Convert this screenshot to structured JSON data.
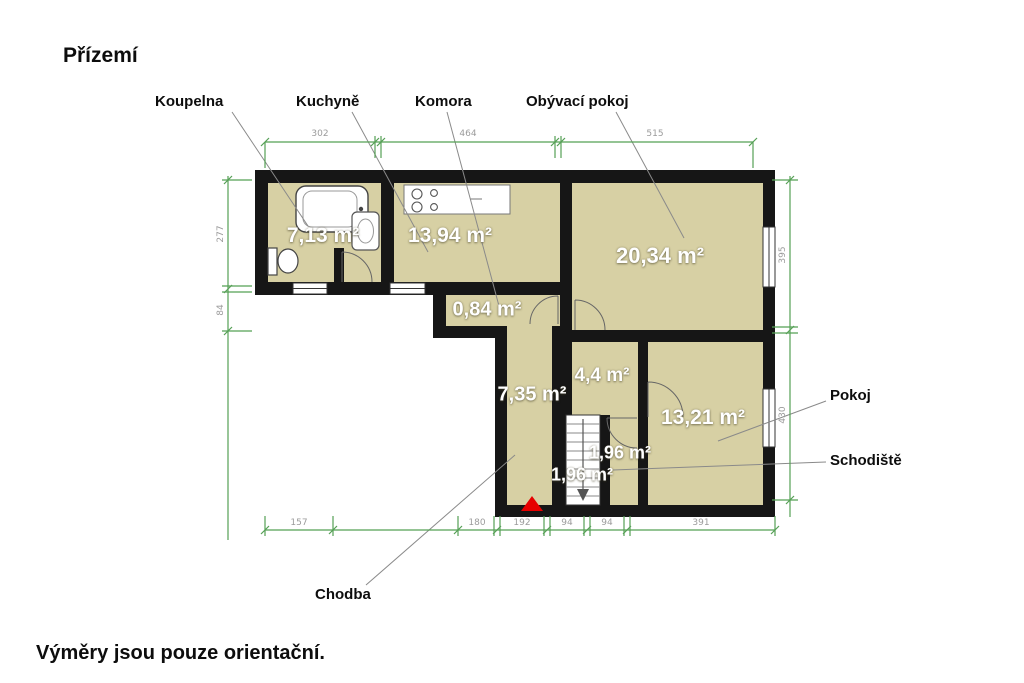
{
  "title": "Přízemí",
  "disclaimer": "Výměry jsou pouze orientační.",
  "floor_plan": {
    "rooms": [
      {
        "name": "Koupelna",
        "area": "7,13 m²"
      },
      {
        "name": "Kuchyně",
        "area": "13,94 m²"
      },
      {
        "name": "Komora",
        "area": "0,84 m²"
      },
      {
        "name": "Obývací pokoj",
        "area": "20,34 m²"
      },
      {
        "name": "",
        "area": "4,4 m²"
      },
      {
        "name": "Pokoj",
        "area": "13,21 m²"
      },
      {
        "name": "Schodiště",
        "area": "1,96 m²",
        "area_duplicate": "1,96 m²"
      },
      {
        "name": "Chodba",
        "area": "7,35 m²"
      }
    ],
    "dimensions_cm": {
      "top": [
        "302",
        "464",
        "515"
      ],
      "bottom": [
        "157",
        "180",
        "192",
        "94",
        "94",
        "391"
      ],
      "left": [
        "277",
        "84"
      ],
      "right": [
        "395",
        "430"
      ]
    },
    "colors": {
      "room_fill": "#d7d0a4",
      "wall": "#161616",
      "dimension_line": "#55a055",
      "dimension_text": "#9b9b9b",
      "leader_line": "#8a8a8a",
      "entrance_marker": "#e60000",
      "area_text": "#ffffff"
    },
    "markers": [
      {
        "type": "entrance-triangle",
        "color": "#e60000"
      }
    ]
  }
}
